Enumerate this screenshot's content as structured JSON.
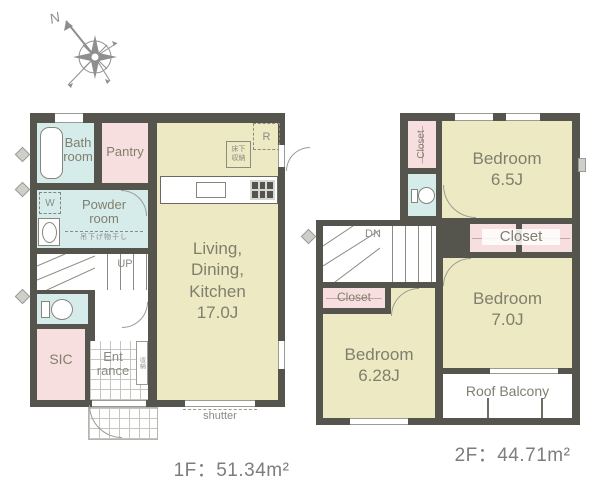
{
  "compass": {
    "north_label": "N"
  },
  "floor1": {
    "area_label": "1F：51.34m²",
    "rooms": {
      "bath": {
        "label": "Bath\nroom"
      },
      "pantry": {
        "label": "Pantry"
      },
      "powder": {
        "label": "Powder\nroom"
      },
      "ldk": {
        "label": "Living,\nDining,\nKitchen\n17.0J"
      },
      "sic": {
        "label": "SIC"
      },
      "entrance": {
        "label": "Ent\nrance"
      }
    },
    "labels": {
      "up": "UP",
      "shutter": "shutter",
      "washer": "W",
      "fridge": "R",
      "floor_storage": "床下\n収納",
      "laundry_pole": "吊下げ物干し",
      "storage": "収納"
    }
  },
  "floor2": {
    "area_label": "2F：44.71m²",
    "rooms": {
      "bedroom65": {
        "label": "Bedroom\n6.5J"
      },
      "bedroom70": {
        "label": "Bedroom\n7.0J"
      },
      "bedroom628": {
        "label": "Bedroom\n6.28J"
      },
      "closet_tall": {
        "label": "Closet"
      },
      "closet_row": {
        "label": "Closet"
      },
      "closet_small": {
        "label": "Closet"
      },
      "balcony": {
        "label": "Roof Balcony"
      }
    },
    "labels": {
      "down": "DN"
    }
  },
  "colors": {
    "wall": "#56554d",
    "room_beige": "#ece9c3",
    "room_pink": "#f8dfdf",
    "room_blue": "#d6eceb",
    "fixture_line": "#85857d",
    "room_label": "#807f6d",
    "muted_label": "#8a8a85",
    "area_label": "#7d7d7d",
    "compass": "#8e8e8e"
  }
}
